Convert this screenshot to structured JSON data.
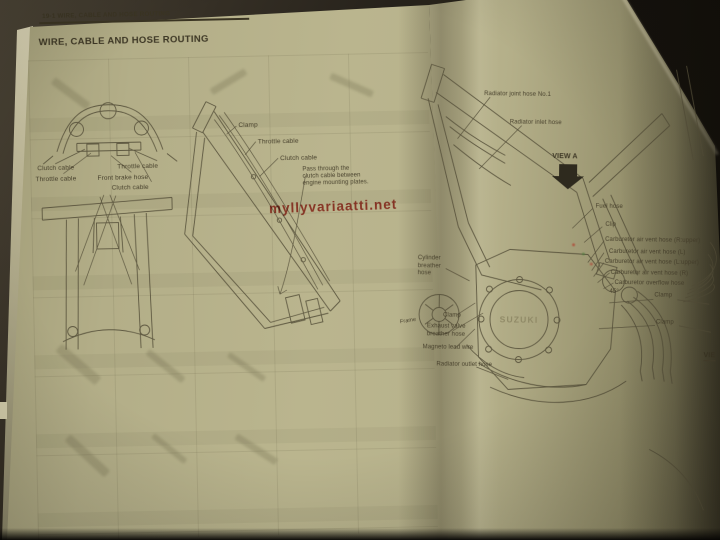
{
  "watermark": {
    "text": "myllyvariaatti.net"
  },
  "left_page": {
    "running_header": "19-1 WIRE, CABLE AND HOSE ROUTING",
    "title": "WIRE, CABLE AND HOSE ROUTING",
    "handlebar_labels": {
      "clutch_cable_left": "Clutch cable",
      "throttle_cable_left": "Throttle cable",
      "throttle_cable_right": "Throttle cable",
      "front_brake_hose": "Front brake hose",
      "clutch_cable_right": "Clutch cable"
    },
    "frame_labels": {
      "clamp": "Clamp",
      "throttle_cable": "Throttle cable",
      "clutch_cable": "Clutch cable",
      "routing_note": "Pass through the\nclutch cable between\nengine mounting plates."
    }
  },
  "right_page": {
    "labels": {
      "radiator_joint_hose": "Radiator joint hose No.1",
      "radiator_inlet_hose": "Radiator inlet hose",
      "view_a": "VIEW A",
      "fuel_hose": "Fuel hose",
      "clip": "Clip",
      "carb_air_vent_r_upper": "Carburetor air vent hose (R:upper)",
      "carb_air_vent_l": "Carburetor air vent hose (L)",
      "carb_air_vent_l_upper": "Carburetor air vent hose (L:upper)",
      "carb_air_vent_r": "Carburetor air vent hose (R)",
      "carb_overflow": "Carburetor overflow hose",
      "angle_45": "45°",
      "clamp_upper": "Clamp",
      "clamp_lower": "Clamp",
      "cylinder_breather_hose": "Cylinder\nbreather\nhose",
      "clamp_left": "Clamp",
      "exhaust_valve_breather": "Exhaust valve\nbreather hose",
      "magneto_lead_wire": "Magneto lead wire",
      "radiator_outlet_hose": "Radiator outlet hose",
      "frame": "Frame",
      "engine_logo": "SUZUKI",
      "view_b_partial": "VIE"
    }
  }
}
